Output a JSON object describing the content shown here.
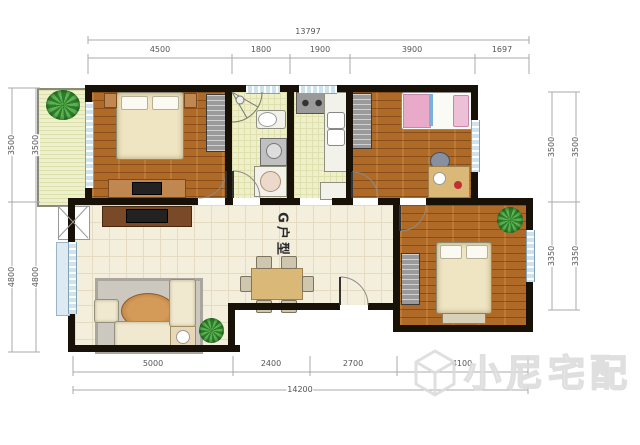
{
  "plan": {
    "label": "G户型"
  },
  "watermark": {
    "brand": "小尼宅配"
  },
  "dimensions": {
    "top": {
      "total": "13797",
      "segments": [
        "4500",
        "1800",
        "1900",
        "3900",
        "1697"
      ]
    },
    "bottom": {
      "total": "14200",
      "segments": [
        "5000",
        "2400",
        "2700",
        "4100"
      ]
    },
    "left": {
      "segments": [
        "3500",
        "4800"
      ]
    },
    "right": {
      "segments": [
        "3500",
        "3350"
      ]
    }
  },
  "colors": {
    "wall": "#181108",
    "wood_floor": "#b06a28",
    "tile_floor": "#f4eedd",
    "wet_floor": "#eef0c9",
    "balcony_floor": "#edf0cc",
    "window": "#cfe3ef",
    "plant": "#2e7d2e"
  },
  "icons": {
    "plant": "potted-plant",
    "logo": "cube-hexagon"
  }
}
